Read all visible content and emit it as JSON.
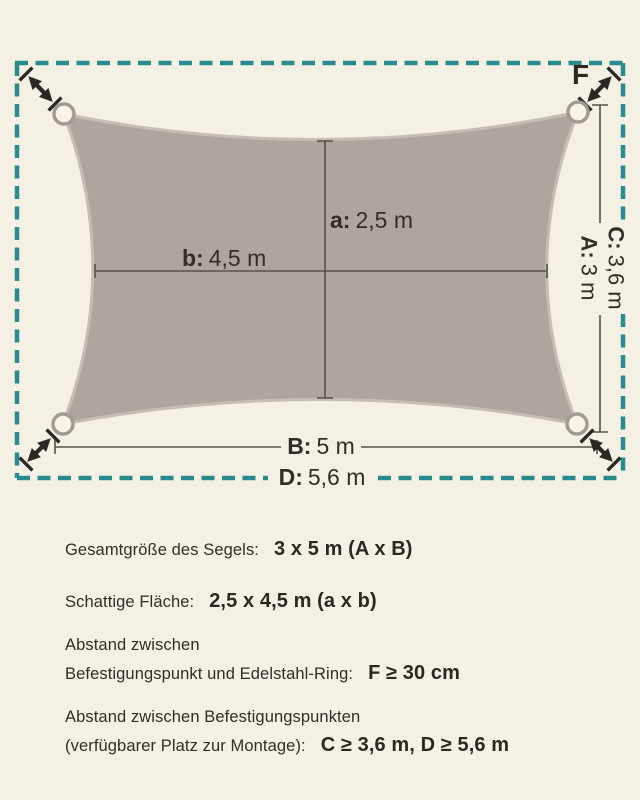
{
  "diagram": {
    "colors": {
      "background": "#f4f0e3",
      "sail_fill": "#aea69e",
      "sail_edge": "#c6beb4",
      "dashed_border_teal": "#2a8b8f",
      "dimension_line": "#56514b",
      "arrow": "#2b2723",
      "text": "#312d28"
    },
    "dimension_labels": {
      "a": {
        "prefix": "a:",
        "value": "2,5 m"
      },
      "b": {
        "prefix": "b:",
        "value": "4,5 m"
      },
      "B": {
        "prefix": "B:",
        "value": "5 m"
      },
      "D": {
        "prefix": "D:",
        "value": "5,6 m"
      },
      "C": {
        "prefix": "C:",
        "value": "3,6 m"
      },
      "A": {
        "prefix": "A:",
        "value": "3 m"
      },
      "F": "F"
    }
  },
  "specs": {
    "overall_size": {
      "label": "Gesamtgröße des Segels:",
      "value": "3 x 5 m (A x B)"
    },
    "shaded_area": {
      "label": "Schattige Fläche:",
      "value": "2,5 x 4,5 m (a x b)"
    },
    "ring_distance": {
      "label_line1": "Abstand zwischen",
      "label_line2": "Befestigungspunkt und Edelstahl-Ring:",
      "value": "F ≥ 30 cm"
    },
    "mounting_distance": {
      "label_line1": "Abstand zwischen Befestigungspunkten",
      "label_line2": "(verfügbarer Platz zur Montage):",
      "value": "C ≥ 3,6 m, D ≥ 5,6 m"
    }
  }
}
